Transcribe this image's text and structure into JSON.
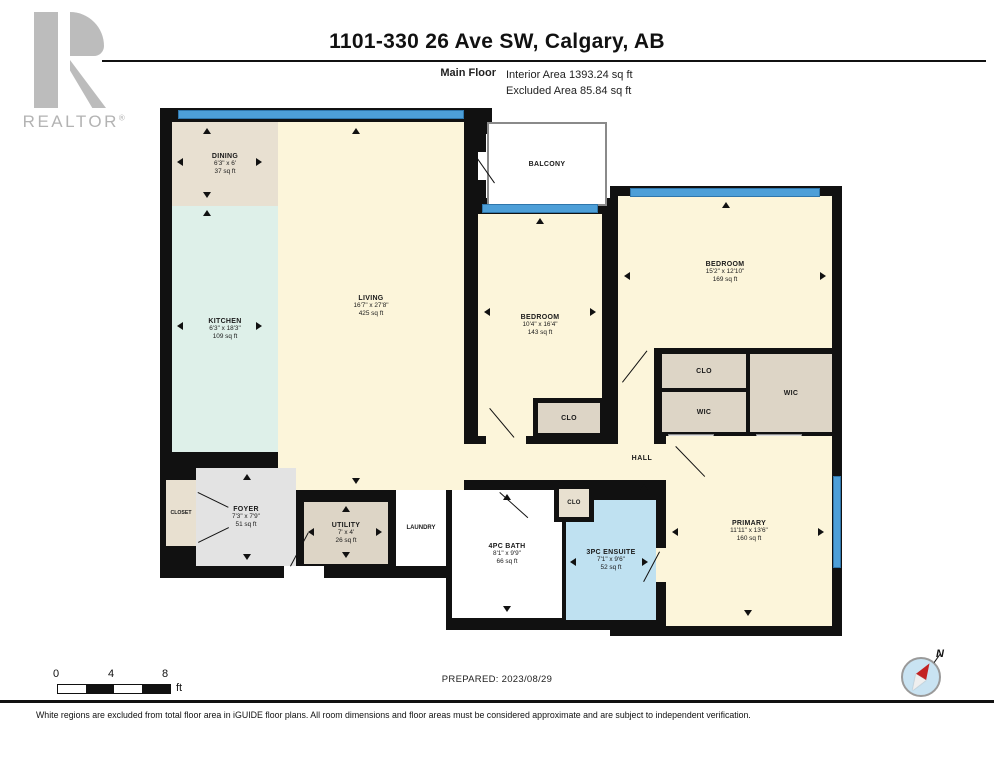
{
  "header": {
    "title": "1101-330 26 Ave SW, Calgary, AB",
    "floor_label": "Main Floor",
    "interior_area": "Interior Area 1393.24 sq ft",
    "excluded_area": "Excluded Area 85.84 sq ft"
  },
  "logo": {
    "word": "REALTOR",
    "registered": "®"
  },
  "rooms": {
    "dining": {
      "name": "DINING",
      "dims": "6'3\" x 6'",
      "area": "37 sq ft"
    },
    "kitchen": {
      "name": "KITCHEN",
      "dims": "6'3\" x 18'3\"",
      "area": "109 sq ft"
    },
    "living": {
      "name": "LIVING",
      "dims": "16'7\" x 27'8\"",
      "area": "425 sq ft"
    },
    "balcony": {
      "name": "BALCONY"
    },
    "bedroom1": {
      "name": "BEDROOM",
      "dims": "10'4\" x 16'4\"",
      "area": "143 sq ft"
    },
    "bedroom2": {
      "name": "BEDROOM",
      "dims": "15'2\" x 12'10\"",
      "area": "169 sq ft"
    },
    "clo1": {
      "name": "CLO"
    },
    "clo2": {
      "name": "CLO"
    },
    "wic1": {
      "name": "WIC"
    },
    "wic2": {
      "name": "WIC"
    },
    "hall": {
      "name": "HALL"
    },
    "primary": {
      "name": "PRIMARY",
      "dims": "11'11\" x 13'6\"",
      "area": "160 sq ft"
    },
    "foyer": {
      "name": "FOYER",
      "dims": "7'3\" x 7'9\"",
      "area": "51 sq ft"
    },
    "closet": {
      "name": "CLOSET"
    },
    "utility": {
      "name": "UTILITY",
      "dims": "7' x 4'",
      "area": "26 sq ft"
    },
    "laundry": {
      "name": "LAUNDRY"
    },
    "bath": {
      "name": "4PC BATH",
      "dims": "8'1\" x 9'9\"",
      "area": "66 sq ft"
    },
    "clo3": {
      "name": "CLO"
    },
    "ensuite": {
      "name": "3PC ENSUITE",
      "dims": "7'1\" x 9'6\"",
      "area": "52 sq ft"
    }
  },
  "scale_bar": {
    "tick0": "0",
    "tick1": "4",
    "tick2": "8",
    "unit": "ft"
  },
  "footer": {
    "prepared": "PREPARED: 2023/08/29",
    "disclaimer": "White regions are excluded from total floor area in iGUIDE floor plans. All room dimensions and floor areas must be considered approximate and are subject to independent verification.",
    "compass_label": "N"
  },
  "colors": {
    "wall": "#111111",
    "window_blue": "#4d9fd8",
    "room_cream": "#fcf5da",
    "kitchen_teal": "#def0e9",
    "closet_taupe": "#ddd5c6",
    "foyer_gray": "#e3e3e3",
    "ensuite_blue": "#bfe1f1",
    "dining_beige": "#e8e0d1"
  }
}
